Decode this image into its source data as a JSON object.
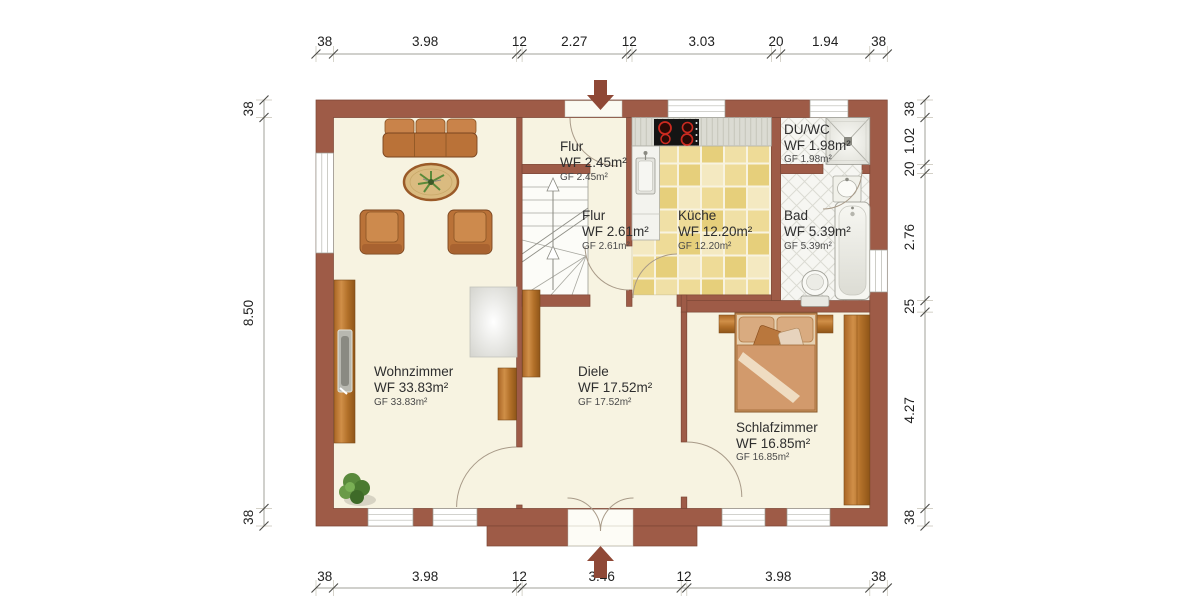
{
  "colors": {
    "wall": "#9e5b47",
    "wall_edge": "#7c4636",
    "floor": "#f7f3e1",
    "kitchen_tile": "#eedb97",
    "bath_tile": "#f6f6f2",
    "wood": "#b4702a",
    "entry_arrow": "#8f4836"
  },
  "dims": {
    "top": [
      "38",
      "3.98",
      "12",
      "2.27",
      "12",
      "3.03",
      "20",
      "1.94",
      "38"
    ],
    "bottom": [
      "38",
      "3.98",
      "12",
      "3.46",
      "12",
      "3.98",
      "38"
    ],
    "left": [
      "38",
      "8.50",
      "38"
    ],
    "right": [
      "38",
      "1.02",
      "20",
      "2.76",
      "25",
      "4.27",
      "38"
    ]
  },
  "rooms": {
    "flur1": {
      "name": "Flur",
      "wf": "WF 2.45m²",
      "gf": "GF 2.45m²"
    },
    "flur2": {
      "name": "Flur",
      "wf": "WF 2.61m²",
      "gf": "GF 2.61m²"
    },
    "kueche": {
      "name": "Küche",
      "wf": "WF 12.20m²",
      "gf": "GF 12.20m²"
    },
    "duwc": {
      "name": "DU/WC",
      "wf": "WF 1.98m²",
      "gf": "GF 1.98m²"
    },
    "bad": {
      "name": "Bad",
      "wf": "WF 5.39m²",
      "gf": "GF 5.39m²"
    },
    "wohnzimmer": {
      "name": "Wohnzimmer",
      "wf": "WF 33.83m²",
      "gf": "GF 33.83m²"
    },
    "diele": {
      "name": "Diele",
      "wf": "WF 17.52m²",
      "gf": "GF 17.52m²"
    },
    "schlafzimmer": {
      "name": "Schlafzimmer",
      "wf": "WF 16.85m²",
      "gf": "GF 16.85m²"
    }
  }
}
